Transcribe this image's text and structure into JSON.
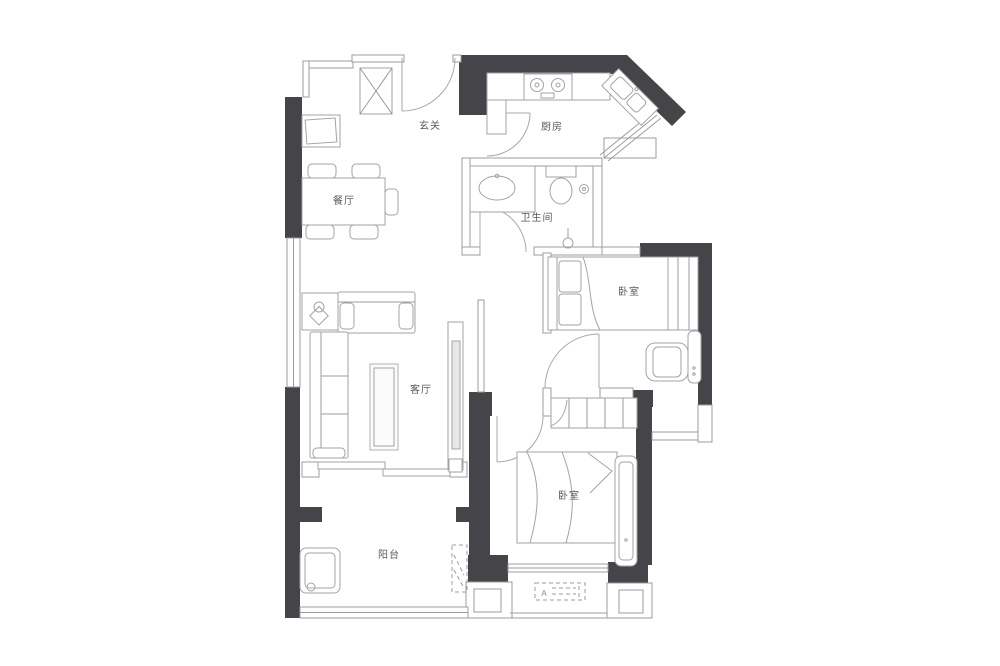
{
  "floorplan": {
    "rooms": [
      {
        "id": "entry",
        "label": "玄关"
      },
      {
        "id": "kitchen",
        "label": "厨房"
      },
      {
        "id": "dining",
        "label": "餐厅"
      },
      {
        "id": "bathroom",
        "label": "卫生间"
      },
      {
        "id": "bedroom-north",
        "label": "卧室"
      },
      {
        "id": "living",
        "label": "客厅"
      },
      {
        "id": "bedroom-south",
        "label": "卧室"
      },
      {
        "id": "balcony",
        "label": "阳台"
      }
    ],
    "markers": {
      "ac_unit": "A"
    },
    "colors": {
      "background": "#ffffff",
      "load_bearing_wall": "#454549",
      "thin_wall_line": "#9c9ca0",
      "furniture_line": "#a3a3a7",
      "label_text": "#5a5a5e"
    }
  }
}
